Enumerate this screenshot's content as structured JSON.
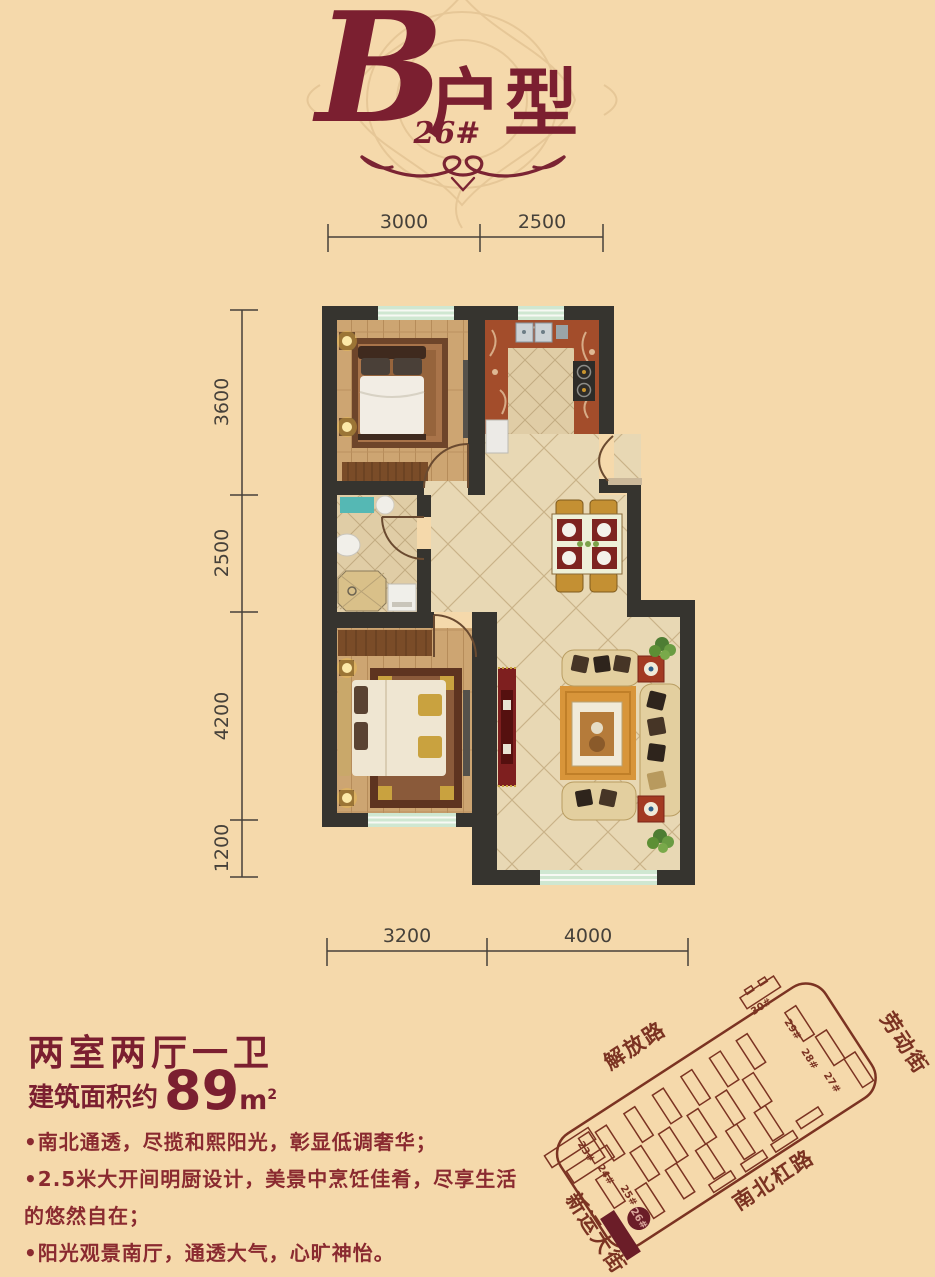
{
  "header": {
    "type_letter": "B",
    "type_name": "户型",
    "building_no": "26#"
  },
  "dimensions": {
    "top": [
      "3000",
      "2500"
    ],
    "left": [
      "3600",
      "2500",
      "4200",
      "1200"
    ],
    "bottom": [
      "3200",
      "4000"
    ]
  },
  "info": {
    "layout_title": "两室两厅一卫",
    "area_prefix": "建筑面积约",
    "area_value": "89",
    "area_unit": "m",
    "area_unit_sup": "2",
    "features": [
      "•南北通透，尽揽和熙阳光，彰显低调奢华；",
      "•2.5米大开间明厨设计，美景中烹饪佳肴，尽享生活的悠然自在；",
      "•阳光观景南厅，通透大气，心旷神怡。"
    ]
  },
  "site_map": {
    "streets": {
      "jiefang": "解放路",
      "laodong": "劳动街",
      "nanbeigang": "南北杠路",
      "xinyun": "新运大街"
    },
    "buildings": {
      "b23": "23#",
      "b24": "24#",
      "b25": "25#",
      "b26": "26#",
      "b27": "27#",
      "b28": "28#",
      "b29": "29#",
      "b30": "30#"
    },
    "highlighted_building": "26#"
  },
  "colors": {
    "background": "#f5d9ab",
    "accent_maroon": "#7b1f30",
    "wall": "#36342f",
    "window_mint": "#cfe7d1",
    "site_line": "#7b3322",
    "kitchen_marble": "#a34d2b",
    "tile": "#e8d8b4",
    "wood": "#cda572"
  }
}
